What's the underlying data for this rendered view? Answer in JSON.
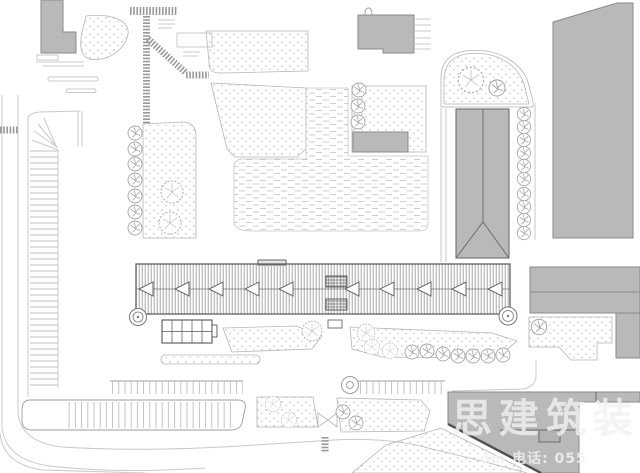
{
  "meta": {
    "type": "architectural-site-plan",
    "width": 640,
    "height": 473
  },
  "watermark": {
    "line1": "思建筑装",
    "line2": "om 电话: 055"
  },
  "colors": {
    "bfill": "#b9b9b9",
    "bstroke": "#8a8a8a",
    "lnlight": "#c8c8c8",
    "lnmed": "#9e9e9e",
    "lndark": "#555555",
    "wmark": "#f2f2f2"
  }
}
